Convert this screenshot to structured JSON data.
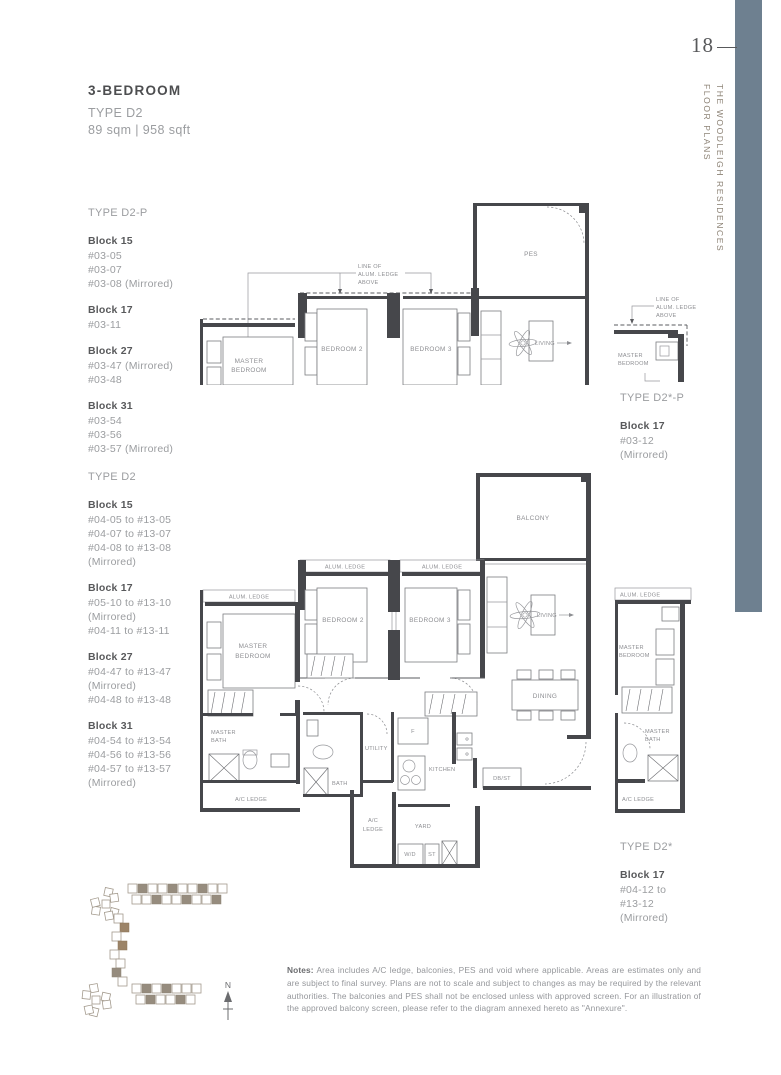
{
  "page": {
    "number": "18",
    "vertical_title_line1": "THE WOODLEIGH RESIDENCES",
    "vertical_title_line2": "FLOOR PLANS",
    "accent_color": "#6e8090"
  },
  "header": {
    "title": "3-BEDROOM",
    "type": "TYPE D2",
    "area": "89 sqm | 958 sqft"
  },
  "left_sections": [
    {
      "type_label": "TYPE D2-P",
      "blocks": [
        {
          "name": "Block 15",
          "units": [
            "#03-05",
            "#03-07",
            "#03-08 (Mirrored)"
          ]
        },
        {
          "name": "Block 17",
          "units": [
            "#03-11"
          ]
        },
        {
          "name": "Block 27",
          "units": [
            "#03-47 (Mirrored)",
            "#03-48"
          ]
        },
        {
          "name": "Block 31",
          "units": [
            "#03-54",
            "#03-56",
            "#03-57 (Mirrored)"
          ]
        }
      ]
    },
    {
      "type_label": "TYPE D2",
      "blocks": [
        {
          "name": "Block 15",
          "units": [
            "#04-05 to #13-05",
            "#04-07 to #13-07",
            "#04-08 to #13-08",
            "(Mirrored)"
          ]
        },
        {
          "name": "Block 17",
          "units": [
            "#05-10 to #13-10",
            "(Mirrored)",
            "#04-11 to #13-11"
          ]
        },
        {
          "name": "Block 27",
          "units": [
            "#04-47 to #13-47",
            "(Mirrored)",
            "#04-48 to #13-48"
          ]
        },
        {
          "name": "Block 31",
          "units": [
            "#04-54 to #13-54",
            "#04-56 to #13-56",
            "#04-57 to #13-57",
            "(Mirrored)"
          ]
        }
      ]
    }
  ],
  "right_sections": [
    {
      "type_label": "TYPE D2*-P",
      "blocks": [
        {
          "name": "Block 17",
          "units": [
            "#03-12",
            "(Mirrored)"
          ]
        }
      ]
    },
    {
      "type_label": "TYPE D2*",
      "blocks": [
        {
          "name": "Block 17",
          "units": [
            "#04-12 to",
            "#13-12",
            "(Mirrored)"
          ]
        }
      ]
    }
  ],
  "plan_labels": {
    "line_of_ledge": [
      "LINE OF",
      "ALUM. LEDGE",
      "ABOVE"
    ],
    "alum_ledge": "ALUM. LEDGE",
    "pes": "PES",
    "balcony": "BALCONY",
    "master_bedroom": [
      "MASTER",
      "BEDROOM"
    ],
    "bedroom2": "BEDROOM 2",
    "bedroom3": "BEDROOM 3",
    "living": "LIVING",
    "dining": "DINING",
    "master_bath": [
      "MASTER",
      "BATH"
    ],
    "bath": "BATH",
    "utility": "UTILITY",
    "kitchen": "KITCHEN",
    "fridge": "F",
    "dbst": "DB/ST",
    "ac_ledge": "A/C LEDGE",
    "ac_ledge_two": [
      "A/C",
      "LEDGE"
    ],
    "yard": "YARD",
    "wd": "W/D",
    "st": "ST",
    "north": "N"
  },
  "notes": {
    "label": "Notes:",
    "body": " Area includes A/C ledge, balconies, PES and void where applicable. Areas are estimates only and are subject to final survey. Plans are not to scale and subject to changes as may be required by the relevant authorities. The balconies and PES shall not be enclosed unless with approved screen. For an illustration of the approved balcony screen, please refer to the diagram annexed hereto as \"Annexure\"."
  }
}
